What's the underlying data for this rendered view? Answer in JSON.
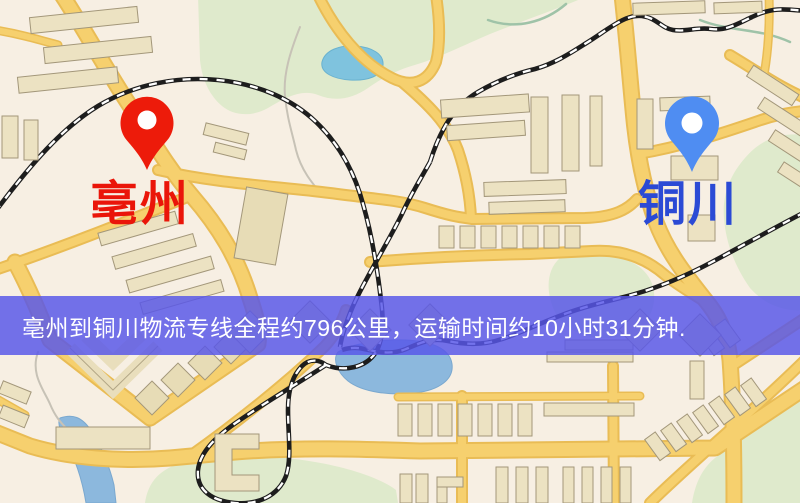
{
  "map": {
    "markers": {
      "origin": {
        "name": "亳州",
        "pin_color": "#ed1b0a",
        "label_color": "#ea1509",
        "pin_icon": "red-map-pin"
      },
      "destination": {
        "name": "铜川",
        "pin_color": "#4f8df2",
        "label_color": "#2b4ad5",
        "pin_icon": "blue-map-pin"
      }
    },
    "banner": {
      "text": "亳州到铜川物流专线全程约796公里，运输时间约10小时31分钟.",
      "background_color": "#5857e8",
      "text_color": "#ffffff",
      "distance_km": "796",
      "duration": "10小时31分钟"
    },
    "palette": {
      "land": "#f7efe3",
      "road_fill": "#f6d06e",
      "road_edge": "#e9bc55",
      "building": "#ece2c2",
      "park": "#dfeacc",
      "water": "#7fc3de",
      "railway": "#1d1d1d"
    }
  }
}
